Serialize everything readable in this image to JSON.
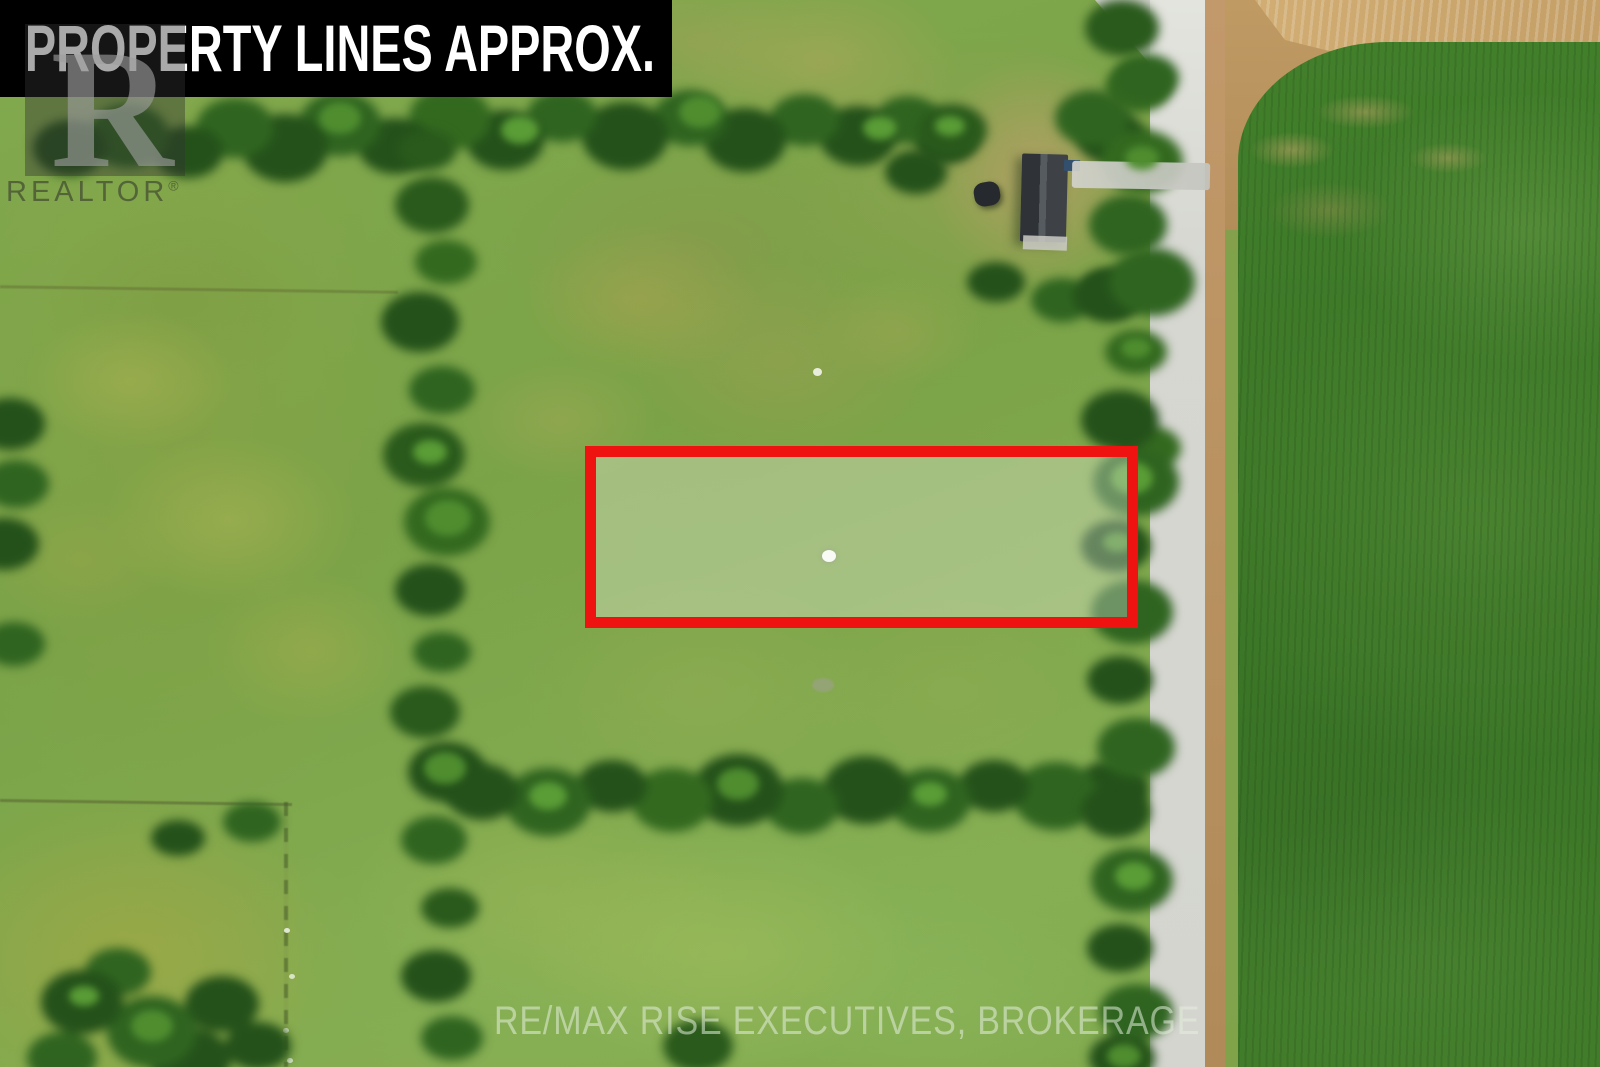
{
  "banner": {
    "text": "PROPERTY LINES APPROX."
  },
  "watermarks": {
    "realtor_logo_letter": "R",
    "realtor_text": "REALTOR",
    "registered_symbol": "®",
    "brokerage_text": "RE/MAX RISE EXECUTIVES, BROKERAGE"
  },
  "property_outline": {
    "border_color": "#ee1310",
    "fill": "rgba(255,255,255,0.30)"
  },
  "colors": {
    "banner_bg": "#000000",
    "banner_text": "#ffffff",
    "property_red": "#ee1310",
    "outline_fill": "rgba(255,255,255,0.30)",
    "crop_green": "#3a7526",
    "road_gray": "#d4d5cf",
    "shoulder_tan": "#b08a58",
    "dirt_tan": "#c09a63",
    "roof_gray": "#3e4247",
    "watermark_text": "rgba(228,238,220,0.55)"
  }
}
